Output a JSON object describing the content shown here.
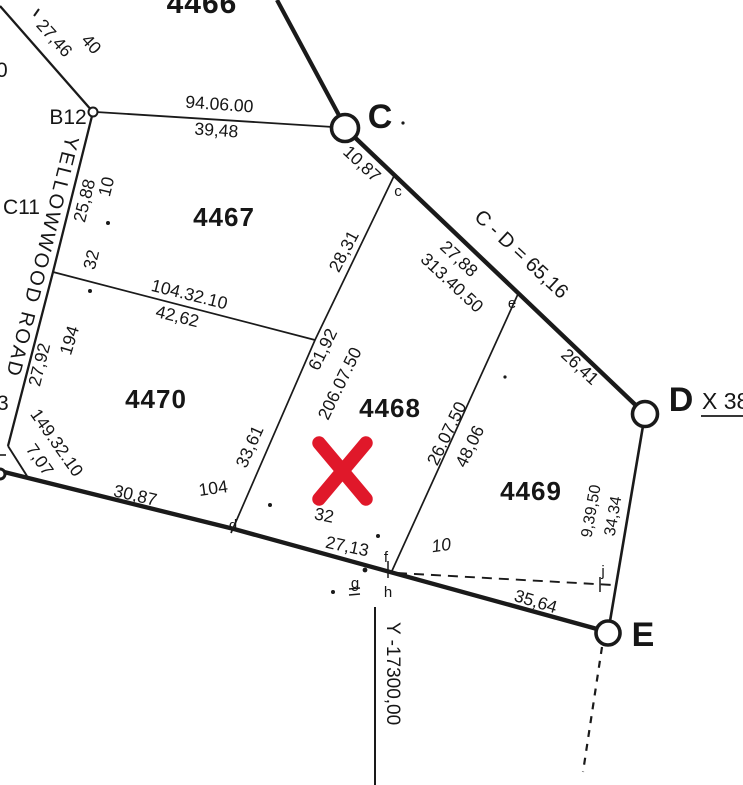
{
  "canvas": {
    "width": 743,
    "height": 785,
    "background": "#ffffff",
    "ink_color": "#1a1a1a",
    "mark_color": "#e0182a"
  },
  "parcels": [
    {
      "number": "4466"
    },
    {
      "number": "4467"
    },
    {
      "number": "4468"
    },
    {
      "number": "4469"
    },
    {
      "number": "4470"
    }
  ],
  "stations": [
    {
      "label": "B12"
    },
    {
      "label": "C11"
    },
    {
      "label": "C"
    },
    {
      "label": "D"
    },
    {
      "label": "E"
    }
  ],
  "minor_points": [
    {
      "label": "c"
    },
    {
      "label": "d"
    },
    {
      "label": "e"
    },
    {
      "label": "f"
    },
    {
      "label": "g"
    },
    {
      "label": "h"
    },
    {
      "label": "j"
    }
  ],
  "road": {
    "name": "YELLOWWOOD ROAD"
  },
  "grid": {
    "y_axis_label": "Y -17300,00"
  },
  "annotations": {
    "cd_length": "C - D = 65,16",
    "station_d_coord": "X 38",
    "edge_label_top": "0",
    "edge_label_mid": "3"
  },
  "measurements": {
    "nw_dist": "27,46",
    "nw_road_width": "40",
    "b12_c_bearing": "94.06.00",
    "b12_c_dist": "39,48",
    "c_to_c_dist": "10,87",
    "c_to_e_dist": "27,88",
    "c_to_e_bearing": "313.40.50",
    "e_to_d_dist": "26,41",
    "road_dist_upper": "25,88",
    "road_offset_upper": "10",
    "road_tick_upper": "32",
    "road_tick_lower": "194",
    "road_dist_lower": "27,92",
    "cross_bearing": "104.32.10",
    "cross_dist": "42,62",
    "cd_parcel_upper": "28,31",
    "cd_parcel_total": "61,92",
    "cd_parcel_bearing": "206.07.50",
    "cd_parcel_lower": "33,61",
    "sw_bearing": "149.32.10",
    "sw_dist": "7,07",
    "south_dist_1": "30,87",
    "south_tick_104": "104",
    "south_tick_32": "32",
    "south_dist_2": "27,13",
    "south_tick_10": "10",
    "ef_bearing": "26.07.50",
    "ef_dist": "48,06",
    "de_bearing": "9,39,50",
    "de_dist": "34,34",
    "h_e_dist": "35,64"
  }
}
